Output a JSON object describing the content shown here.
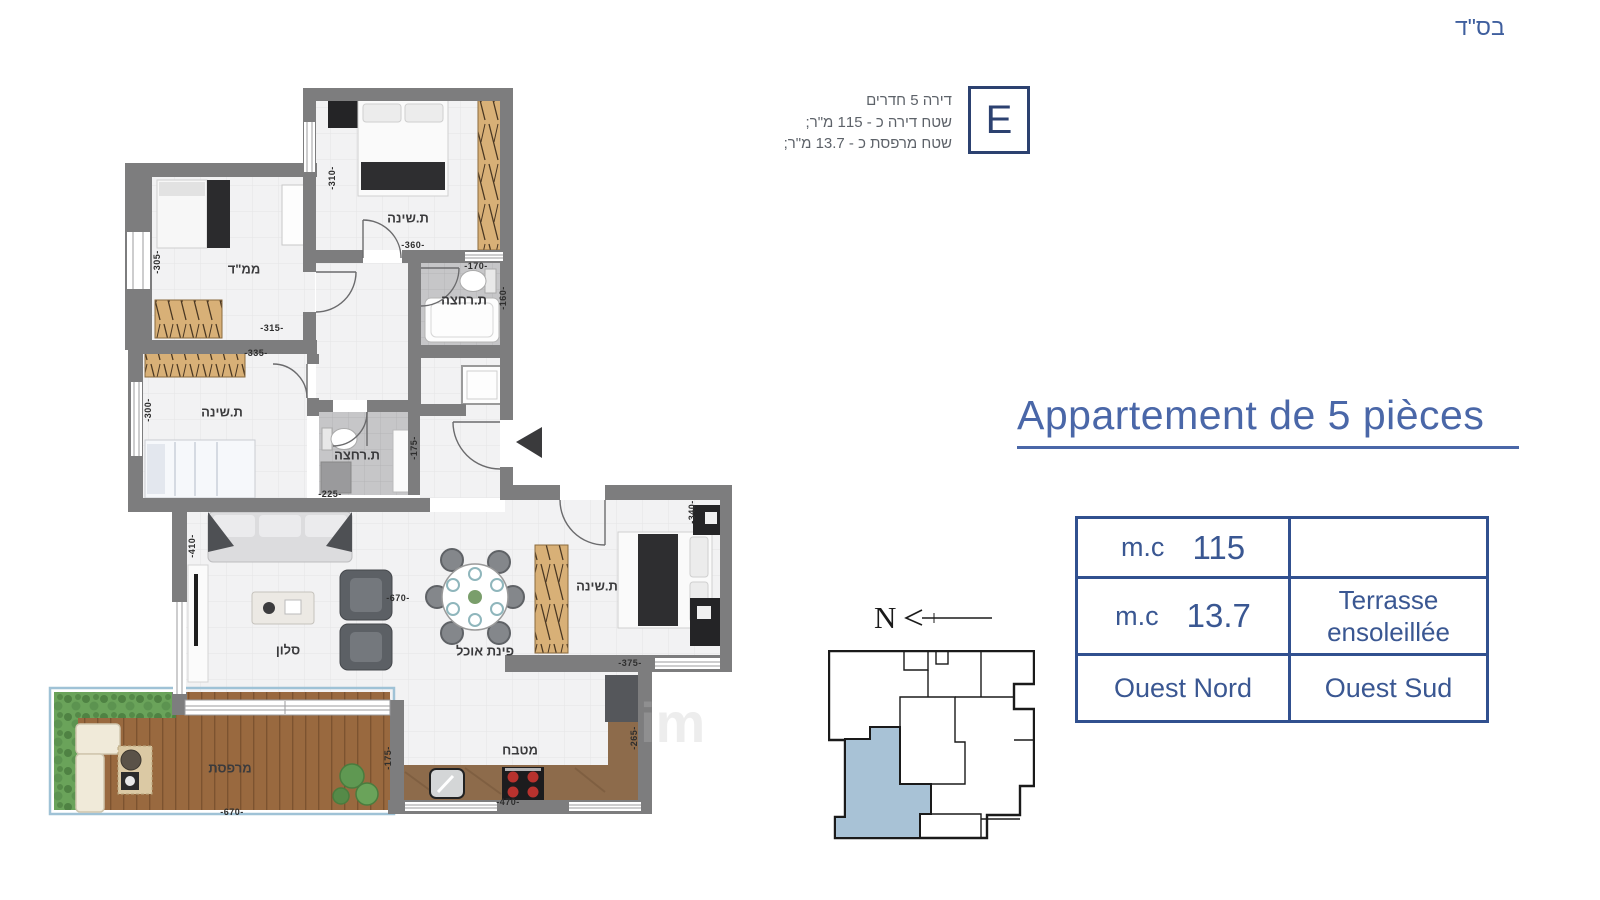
{
  "page": {
    "bsd": "בס\"ד",
    "watermark": "im"
  },
  "info": {
    "badge": "E",
    "lines": [
      "דירה 5 חדרים",
      "שטח דירה כ - 115 מ\"ר;",
      "שטח מרפסת כ - 13.7 מ\"ר;"
    ]
  },
  "title": "Appartement de 5 pièces",
  "table": {
    "rows": [
      {
        "label": "m.c",
        "value": "115",
        "right": ""
      },
      {
        "label": "m.c",
        "value": "13.7",
        "right": "Terrasse ensoleillée"
      },
      {
        "left": "Ouest Nord",
        "right": "Ouest Sud"
      }
    ]
  },
  "compass": {
    "label": "N"
  },
  "plan": {
    "room_labels": [
      "ת.שינה",
      "ממ\"ד",
      "ת.רחצה",
      "ת.שינה",
      "ת.רחצה",
      "סלון",
      "פינת אוכל",
      "ת.שינה",
      "מטבח",
      "מרפסת"
    ],
    "dims": [
      "-305-",
      "-315-",
      "-310-",
      "-360-",
      "-170-",
      "-160-",
      "-335-",
      "-300-",
      "-225-",
      "-175-",
      "-410-",
      "-670-",
      "-340-",
      "-375-",
      "-265-",
      "-470-",
      "-670-",
      "-175-"
    ]
  },
  "colors": {
    "navy": "#2c4170",
    "title_blue": "#4a67a8",
    "table_blue": "#3a5792",
    "wall_gray": "#7d7d7e",
    "highlight_unit": "#a8c2d6"
  }
}
